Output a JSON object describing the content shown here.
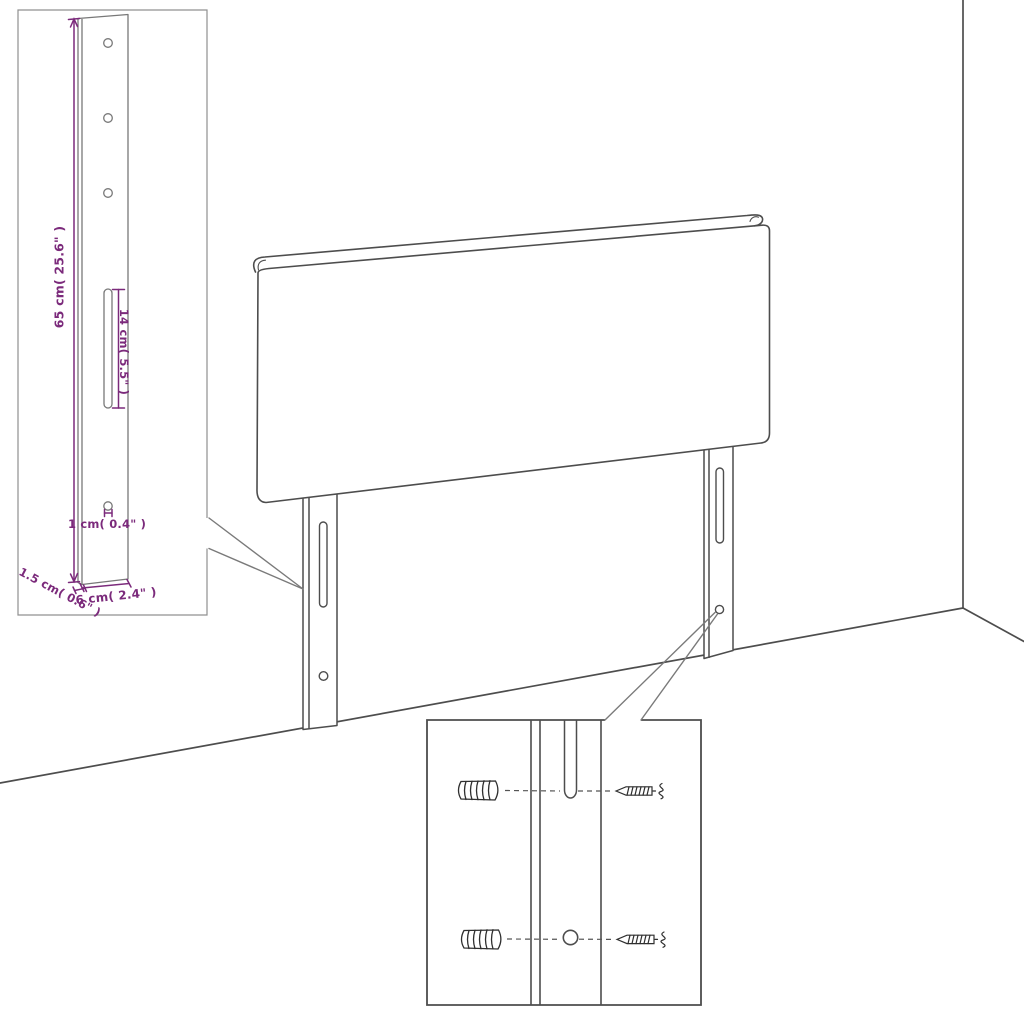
{
  "figure": {
    "type": "product-dimension-diagram",
    "subject": "upholstered headboard with two slotted mounting legs, wall-fixing detail insets",
    "background_color": "#ffffff",
    "line_color": "#4d4d4d",
    "dimension_color": "#7b2a7b",
    "labels": {
      "bracket_height": "65 cm( 25.6\" )",
      "slot_length": "14 cm( 5.5\" )",
      "hole_diameter": "1 cm( 0.4\" )",
      "bracket_thickness": "1.5 cm( 0.6\" )",
      "bracket_width": "6 cm( 2.4\" )"
    },
    "parts": {
      "main": "headboard panel with rolled top edge standing against wall corner",
      "inset_top_left": "magnified mounting leg with 3 holes, long slot and lower hole",
      "inset_bottom": "magnified fixing detail with wall plugs and screws aligned to slot and hole"
    }
  }
}
